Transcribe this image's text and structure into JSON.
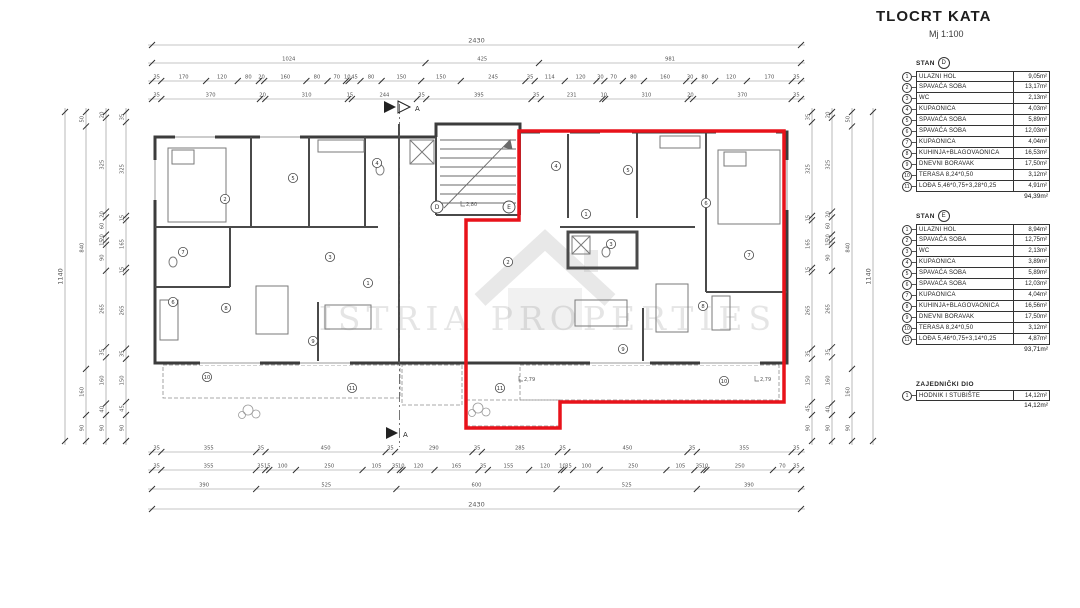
{
  "header": {
    "title": "TLOCRT KATA",
    "scale": "Mj 1:100"
  },
  "watermark": {
    "text": "ISTRIA PROPERTIES"
  },
  "colors": {
    "highlight_red": "#e8121a",
    "wall": "#3c3c3c",
    "dim_line": "#8a8a8a"
  },
  "section": {
    "label": "A"
  },
  "apartments": [
    {
      "title": "STAN",
      "unit": "D",
      "rows": [
        {
          "num": "1",
          "name": "ULAZNI HOL",
          "area": "9,05m²"
        },
        {
          "num": "2",
          "name": "SPAVAĆA SOBA",
          "area": "13,17m²"
        },
        {
          "num": "3",
          "name": "WC",
          "area": "2,13m²"
        },
        {
          "num": "4",
          "name": "KUPAONICA",
          "area": "4,03m²"
        },
        {
          "num": "5",
          "name": "SPAVAĆA SOBA",
          "area": "5,89m²"
        },
        {
          "num": "6",
          "name": "SPAVAĆA SOBA",
          "area": "12,03m²"
        },
        {
          "num": "7",
          "name": "KUPAONICA",
          "area": "4,04m²"
        },
        {
          "num": "8",
          "name": "KUHINJA+BLAGOVAONICA",
          "area": "16,53m²"
        },
        {
          "num": "9",
          "name": "DNEVNI BORAVAK",
          "area": "17,50m²"
        },
        {
          "num": "10",
          "name": "TERASA 8,24*0,50",
          "area": "3,12m²"
        },
        {
          "num": "11",
          "name": "LOĐA 5,46*0,75+3,28*0,25",
          "area": "4,91m²"
        }
      ],
      "total": "94,39m²"
    },
    {
      "title": "STAN",
      "unit": "E",
      "rows": [
        {
          "num": "1",
          "name": "ULAZNI HOL",
          "area": "8,94m²"
        },
        {
          "num": "2",
          "name": "SPAVAĆA SOBA",
          "area": "12,75m²"
        },
        {
          "num": "3",
          "name": "WC",
          "area": "2,13m²"
        },
        {
          "num": "4",
          "name": "KUPAONICA",
          "area": "3,89m²"
        },
        {
          "num": "5",
          "name": "SPAVAĆA SOBA",
          "area": "5,89m²"
        },
        {
          "num": "6",
          "name": "SPAVAĆA SOBA",
          "area": "12,03m²"
        },
        {
          "num": "7",
          "name": "KUPAONICA",
          "area": "4,04m²"
        },
        {
          "num": "8",
          "name": "KUHINJA+BLAGOVAONICA",
          "area": "16,56m²"
        },
        {
          "num": "9",
          "name": "DNEVNI BORAVAK",
          "area": "17,50m²"
        },
        {
          "num": "10",
          "name": "TERASA 8,24*0,50",
          "area": "3,12m²"
        },
        {
          "num": "11",
          "name": "LOĐA 5,46*0,75+3,14*0,25",
          "area": "4,87m²"
        }
      ],
      "total": "93,71m²"
    }
  ],
  "common_area": {
    "title": "ZAJEDNIČKI DIO",
    "rows": [
      {
        "num": "1",
        "name": "HODNIK I STUBIŠTE",
        "area": "14,12m²"
      }
    ],
    "total": "14,12m²"
  },
  "dimensions": {
    "top": [
      [
        2430
      ],
      [
        1024,
        425,
        981
      ],
      [
        35,
        170,
        120,
        80,
        20,
        160,
        80,
        70,
        10,
        45,
        80,
        150,
        150,
        245,
        35,
        114,
        120,
        30,
        70,
        80,
        160,
        30,
        80,
        120,
        170,
        35
      ],
      [
        35,
        370,
        20,
        310,
        15,
        244,
        35,
        395,
        35,
        231,
        10,
        310,
        20,
        370,
        35
      ]
    ],
    "bottom": [
      [
        35,
        355,
        35,
        450,
        35,
        290,
        35,
        285,
        35,
        450,
        35,
        355,
        35
      ],
      [
        35,
        355,
        35,
        15,
        100,
        250,
        105,
        35,
        10,
        120,
        165,
        35,
        155,
        120,
        10,
        35,
        100,
        250,
        105,
        35,
        10,
        250,
        70,
        35
      ],
      [
        390,
        525,
        600,
        525,
        390
      ],
      [
        2430
      ]
    ],
    "left": [
      [
        1140
      ],
      [
        50,
        840,
        160,
        90
      ],
      [
        20,
        325,
        20,
        60,
        20,
        15,
        90,
        265,
        35,
        160,
        40,
        90
      ],
      [
        35,
        325,
        15,
        165,
        15,
        265,
        35,
        150,
        45,
        90
      ]
    ],
    "right": [
      [
        35,
        325,
        15,
        165,
        15,
        265,
        35,
        150,
        45,
        90
      ],
      [
        20,
        325,
        20,
        60,
        20,
        15,
        90,
        265,
        35,
        160,
        40,
        90
      ],
      [
        50,
        840,
        160,
        90
      ],
      [
        1140
      ]
    ]
  },
  "plan": {
    "unit_markers": [
      {
        "label": "D",
        "x": 437,
        "y": 207
      },
      {
        "label": "E",
        "x": 509,
        "y": 207
      }
    ],
    "room_markers": [
      {
        "label": "1",
        "x": 368,
        "y": 283
      },
      {
        "label": "2",
        "x": 225,
        "y": 199
      },
      {
        "label": "3",
        "x": 330,
        "y": 257
      },
      {
        "label": "4",
        "x": 377,
        "y": 163
      },
      {
        "label": "5",
        "x": 293,
        "y": 178
      },
      {
        "label": "6",
        "x": 173,
        "y": 302
      },
      {
        "label": "7",
        "x": 183,
        "y": 252
      },
      {
        "label": "8",
        "x": 226,
        "y": 308
      },
      {
        "label": "9",
        "x": 313,
        "y": 341
      },
      {
        "label": "10",
        "x": 207,
        "y": 377
      },
      {
        "label": "11",
        "x": 352,
        "y": 388
      },
      {
        "label": "1",
        "x": 586,
        "y": 214
      },
      {
        "label": "2",
        "x": 508,
        "y": 262
      },
      {
        "label": "3",
        "x": 611,
        "y": 244
      },
      {
        "label": "4",
        "x": 556,
        "y": 166
      },
      {
        "label": "5",
        "x": 628,
        "y": 170
      },
      {
        "label": "6",
        "x": 706,
        "y": 203
      },
      {
        "label": "7",
        "x": 749,
        "y": 255
      },
      {
        "label": "8",
        "x": 703,
        "y": 306
      },
      {
        "label": "9",
        "x": 623,
        "y": 349
      },
      {
        "label": "10",
        "x": 724,
        "y": 381
      },
      {
        "label": "11",
        "x": 500,
        "y": 388
      }
    ],
    "level_marks": [
      {
        "text": "2,80",
        "x": 466,
        "y": 206
      },
      {
        "text": "2,79",
        "x": 524,
        "y": 381
      },
      {
        "text": "2,79",
        "x": 760,
        "y": 381
      }
    ]
  }
}
